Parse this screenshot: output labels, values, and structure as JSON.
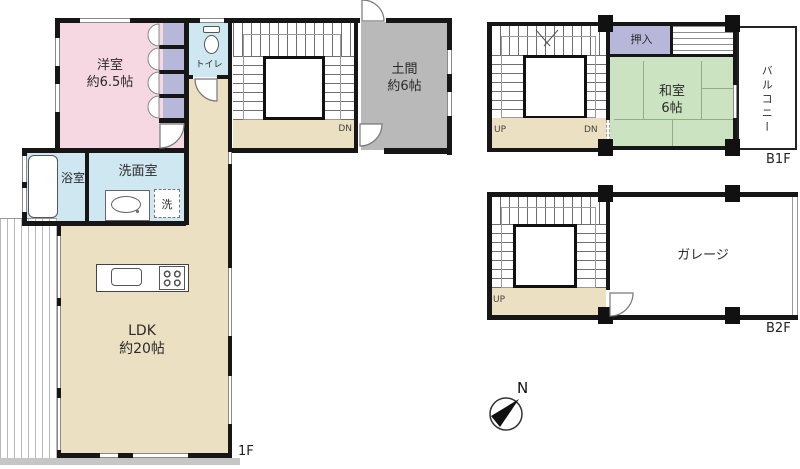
{
  "floor_1f": {
    "label": "1F",
    "rooms": {
      "western_room": {
        "name": "洋室",
        "size": "約6.5帖"
      },
      "toilet": {
        "name": "トイレ"
      },
      "doma": {
        "name": "土間",
        "size": "約6帖"
      },
      "bathroom": {
        "name": "浴室"
      },
      "washroom": {
        "name": "洗面室"
      },
      "laundry": {
        "name": "洗"
      },
      "ldk": {
        "name": "LDK",
        "size": "約20帖"
      }
    },
    "stair": {
      "down": "DN"
    }
  },
  "floor_b1f": {
    "label": "B1F",
    "rooms": {
      "closet": {
        "name": "押入"
      },
      "japanese_room": {
        "name": "和室",
        "size": "6帖"
      },
      "balcony": {
        "name": "バルコニー"
      }
    },
    "stair": {
      "up": "UP",
      "down": "DN"
    }
  },
  "floor_b2f": {
    "label": "B2F",
    "rooms": {
      "garage": {
        "name": "ガレージ"
      }
    },
    "stair": {
      "up": "UP"
    }
  },
  "compass": {
    "north": "N"
  },
  "colors": {
    "western_room_pink": "#f6d8e2",
    "closet_purple": "#b7b7d9",
    "water_blue": "#cfe7f0",
    "hall_tan": "#ece0c2",
    "doma_gray": "#b9b9b9",
    "tatami_green": "#cbe3c0",
    "wall_black": "#161616"
  }
}
